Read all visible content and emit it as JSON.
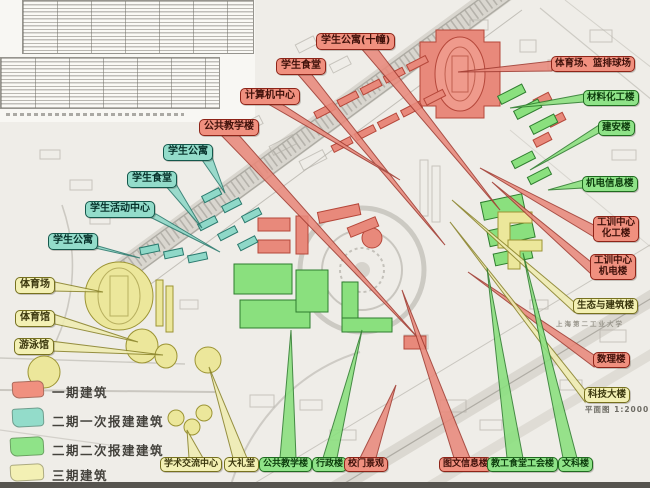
{
  "legend": {
    "items": [
      {
        "label": "一期建筑",
        "phase": "p1",
        "color": "#f0907f"
      },
      {
        "label": "二期一次报建建筑",
        "phase": "p2a",
        "color": "#93dcca"
      },
      {
        "label": "二期二次报建建筑",
        "phase": "p2b",
        "color": "#8fe388"
      },
      {
        "label": "三期建筑",
        "phase": "p3",
        "color": "#f3f0b4"
      }
    ]
  },
  "colors": {
    "phase1": "#e8897b",
    "phase2a": "#8fd8c8",
    "phase2b": "#8ae07e",
    "phase3": "#ece79b"
  },
  "callouts": [
    {
      "text": "学生公寓(十幢)",
      "phase": "p1"
    },
    {
      "text": "学生食堂",
      "phase": "p1"
    },
    {
      "text": "计算机中心",
      "phase": "p1"
    },
    {
      "text": "公共教学楼",
      "phase": "p1"
    },
    {
      "text": "学生公寓",
      "phase": "p2a"
    },
    {
      "text": "学生食堂",
      "phase": "p2a"
    },
    {
      "text": "学生活动中心",
      "phase": "p2a"
    },
    {
      "text": "学生公寓",
      "phase": "p2a"
    },
    {
      "text": "体育场",
      "phase": "p3"
    },
    {
      "text": "体育馆",
      "phase": "p3"
    },
    {
      "text": "游泳馆",
      "phase": "p3"
    },
    {
      "text": "体育场、篮排球场",
      "phase": "p1"
    },
    {
      "text": "材料化工楼",
      "phase": "p2b"
    },
    {
      "text": "建安楼",
      "phase": "p2b"
    },
    {
      "text": "机电信息楼",
      "phase": "p2b"
    },
    {
      "text": "工训中心\n化工楼",
      "phase": "p1"
    },
    {
      "text": "工训中心\n机电楼",
      "phase": "p1"
    },
    {
      "text": "生态与建筑楼",
      "phase": "p3"
    },
    {
      "text": "数理楼",
      "phase": "p1"
    },
    {
      "text": "科技大楼",
      "phase": "p3"
    },
    {
      "text": "学术交流中心",
      "phase": "p3"
    },
    {
      "text": "大礼堂",
      "phase": "p3"
    },
    {
      "text": "公共教学楼",
      "phase": "p2b"
    },
    {
      "text": "行政楼",
      "phase": "p2b"
    },
    {
      "text": "校门景观",
      "phase": "p1"
    },
    {
      "text": "图文信息楼",
      "phase": "p1"
    },
    {
      "text": "教工食堂工会楼",
      "phase": "p2b"
    },
    {
      "text": "文科楼",
      "phase": "p2b"
    }
  ],
  "map_notes": {
    "campus_name": "上海第二工业大学",
    "scale_text": "平面图 1:2000"
  }
}
